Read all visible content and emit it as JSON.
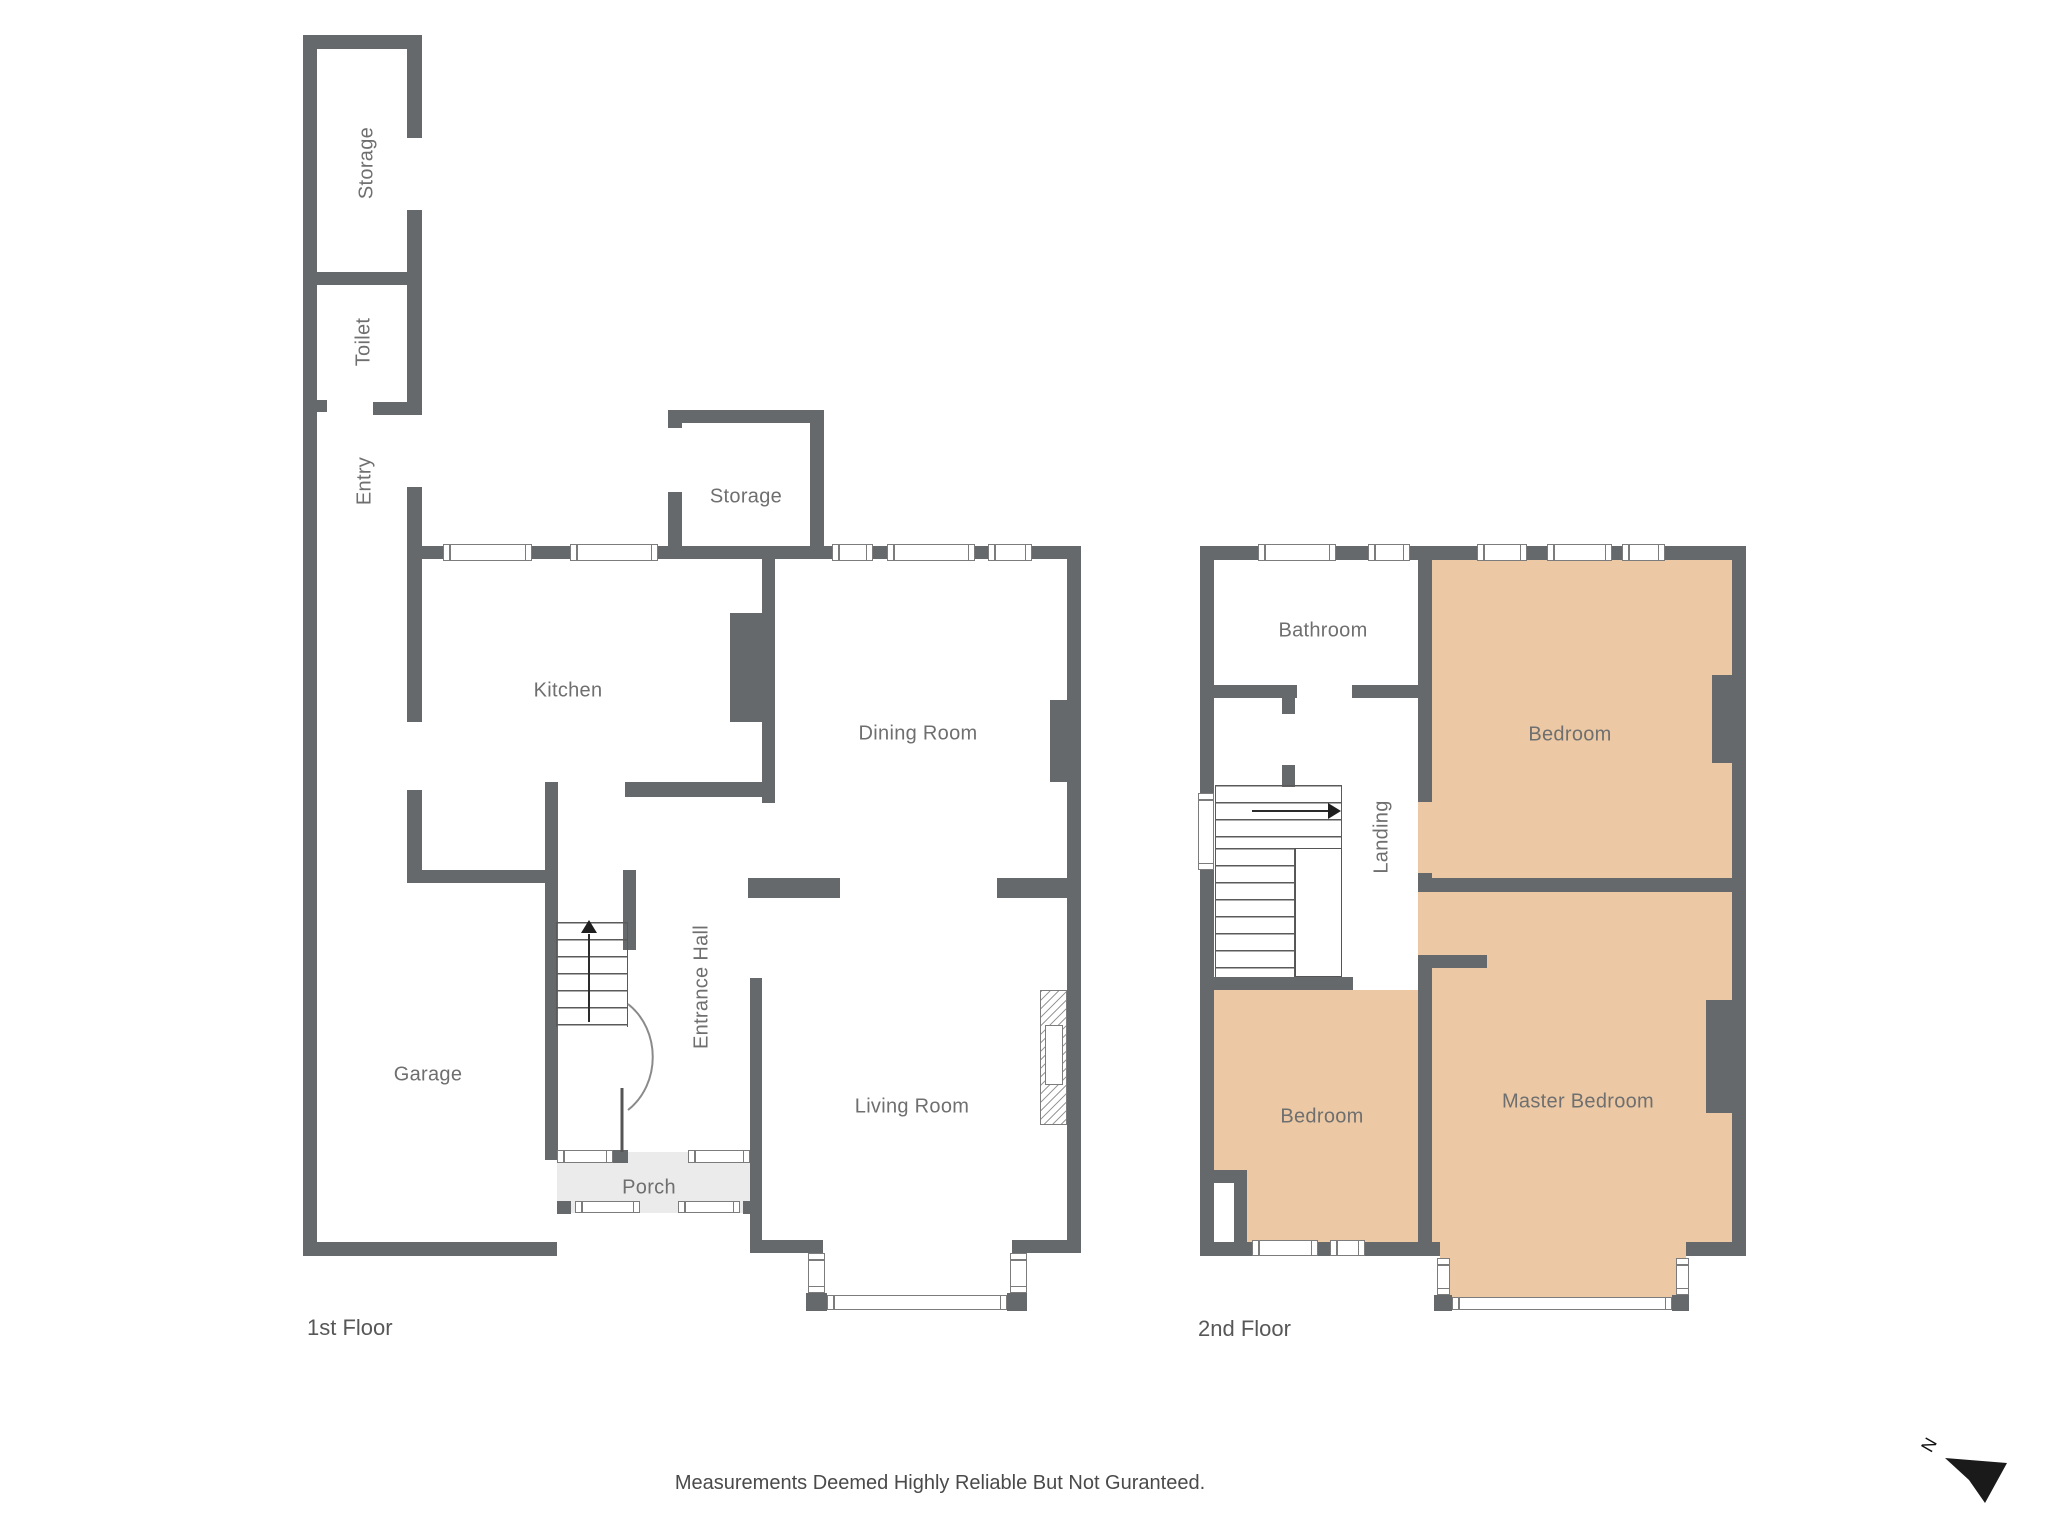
{
  "floor1": {
    "name": "1st Floor",
    "rooms": {
      "storage_wing": "Storage",
      "toilet": "Toilet",
      "entry": "Entry",
      "kitchen": "Kitchen",
      "storage": "Storage",
      "dining_room": "Dining Room",
      "entrance_hall": "Entrance Hall",
      "garage": "Garage",
      "living_room": "Living Room",
      "porch": "Porch"
    }
  },
  "floor2": {
    "name": "2nd Floor",
    "rooms": {
      "bathroom": "Bathroom",
      "bedroom_front": "Bedroom",
      "landing": "Landing",
      "bedroom_back": "Bedroom",
      "master_bedroom": "Master Bedroom"
    }
  },
  "footer": {
    "disclaimer": "Measurements Deemed Highly Reliable But Not Guranteed."
  },
  "compass": {
    "north_label": "N"
  },
  "colors": {
    "wall": "#66696b",
    "bedroom_fill": "#ecc9a4",
    "porch_fill": "#ebebeb",
    "label": "#6f6f6f"
  }
}
